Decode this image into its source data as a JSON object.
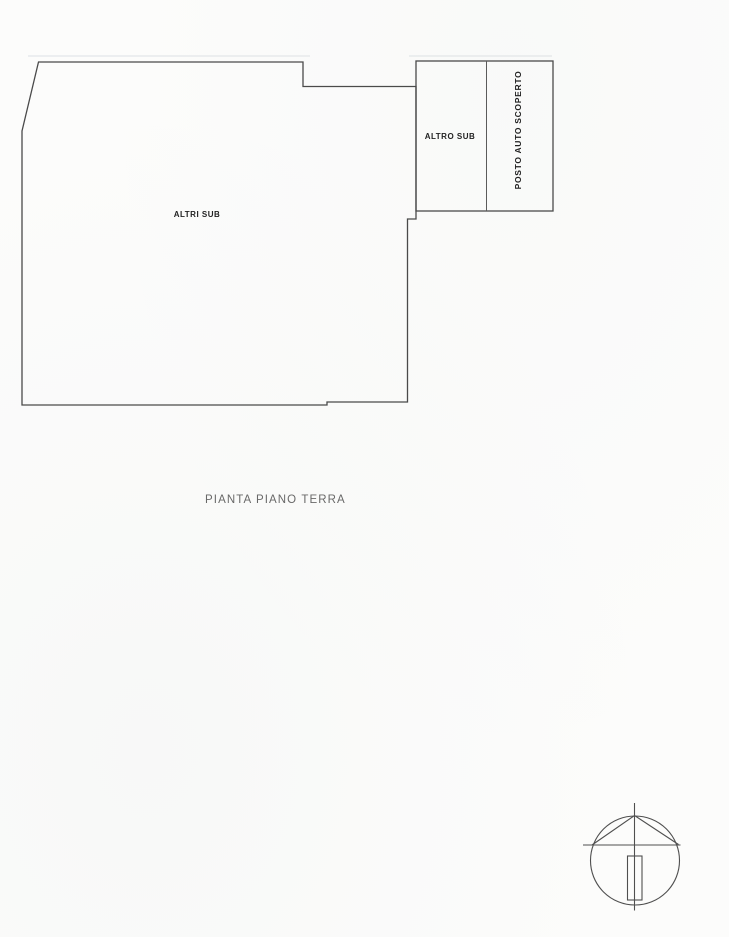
{
  "plan": {
    "labels": {
      "main_area": "ALTRI SUB",
      "secondary_area": "ALTRO SUB",
      "parking_area": "POSTO AUTO SCOPERTO"
    },
    "caption": "PIANTA PIANO TERRA",
    "icons": {
      "north_arrow": "north-arrow-symbol"
    }
  },
  "colors": {
    "line": "#4a4a4a",
    "ink": "#222222",
    "caption_ink": "#4f4f4f",
    "page_bg": "#fcfcfb",
    "ghost": "#dde1e4"
  }
}
